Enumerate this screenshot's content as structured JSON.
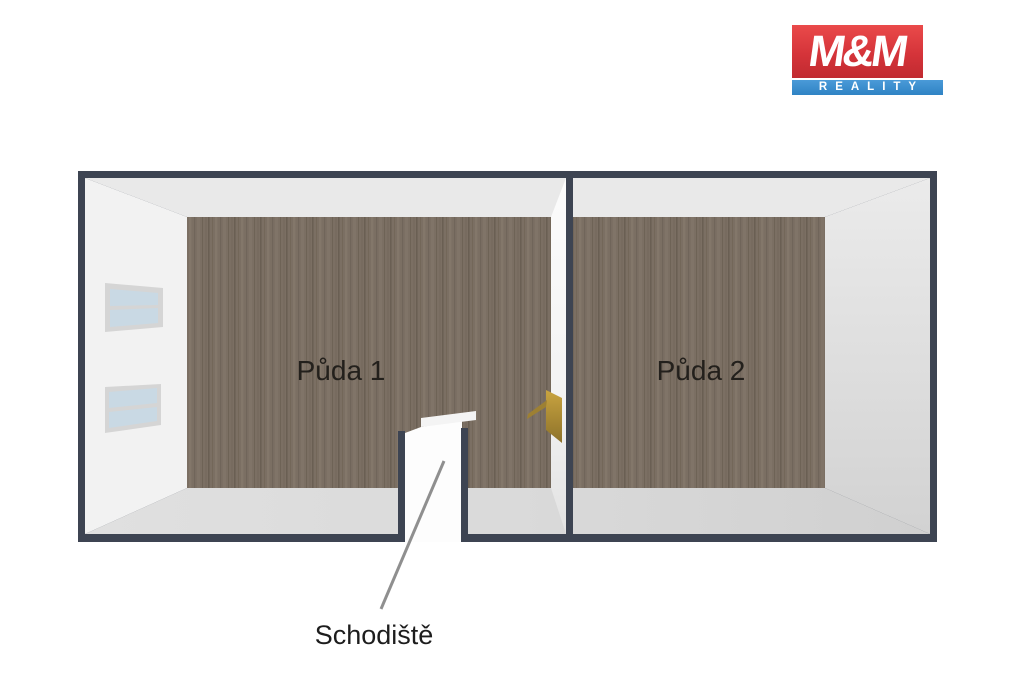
{
  "logo": {
    "mm": "M&M",
    "reality": "REALITY",
    "colors": {
      "red": "#d5343a",
      "blue": "#2f83c4",
      "text": "#ffffff"
    }
  },
  "plan": {
    "rooms": [
      {
        "label": "Půda 1"
      },
      {
        "label": "Půda 2"
      }
    ],
    "stairs_label": "Schodiště",
    "colors": {
      "wall_top": "#3d4452",
      "wall_face_white": "#f2f2f2",
      "floor_wood": "#7b6f63",
      "door_gold": "#b5953f",
      "window_pane": "#c9d9e4",
      "leader_line": "#8f8f8f"
    }
  }
}
